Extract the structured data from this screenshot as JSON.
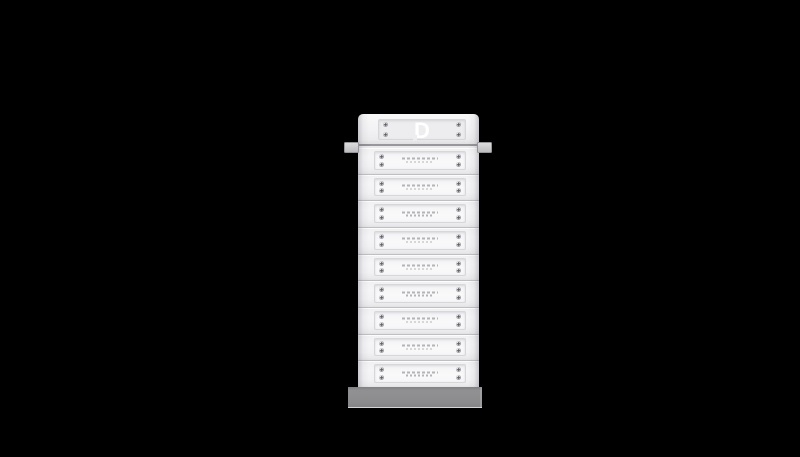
{
  "scene": {
    "kind": "product-render",
    "subject": "Stacked modular battery energy storage tower on black background",
    "canvas": {
      "width": 800,
      "height": 457
    }
  },
  "colors": {
    "background": "#000000",
    "module_face": "#f2f2f4",
    "panel_face": "#f7f7f9",
    "panel_border": "#d7d7da",
    "separator": "#bfbfc2",
    "rail": "#98989c",
    "handle": "#bdbdc0",
    "screw": "#a9a9ad",
    "microtext": "#b4b4b8",
    "base": "#919193",
    "logo": "#ffffff"
  },
  "tower": {
    "brand_logo_letter": "D",
    "top_cover_screws": 4,
    "module_screws": 4,
    "battery_modules": [
      {
        "slot": 1
      },
      {
        "slot": 2
      },
      {
        "slot": 3
      },
      {
        "slot": 4
      },
      {
        "slot": 5
      },
      {
        "slot": 6
      },
      {
        "slot": 7
      },
      {
        "slot": 8
      },
      {
        "slot": 9
      }
    ],
    "module_label": {
      "legible": false,
      "appearance": "tiny gray fine print centered on each module panel"
    },
    "handles": [
      "left",
      "right"
    ]
  }
}
